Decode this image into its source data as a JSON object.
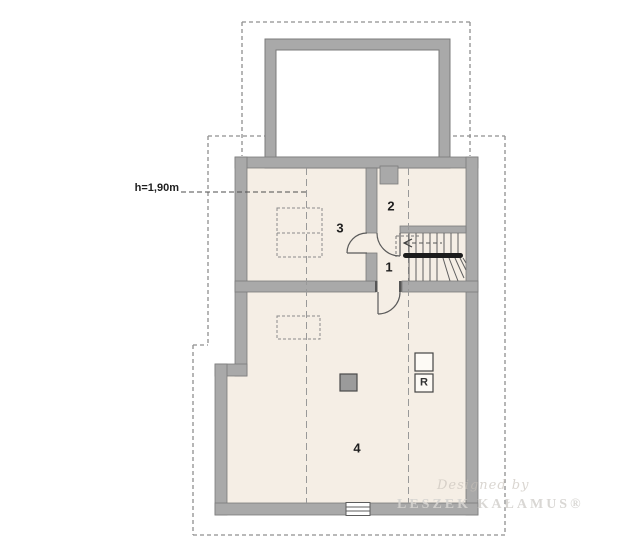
{
  "plan": {
    "annotations": {
      "height_line": "h=1,90m"
    },
    "rooms": {
      "r1": "1",
      "r2": "2",
      "r3": "3",
      "r4": "4"
    },
    "equipment": {
      "r_box": "R"
    },
    "watermark": {
      "designed_by": "Designed by",
      "author": "LESZEK KAŁAMUS®"
    },
    "colors": {
      "wall": "#a9a9a9",
      "floor": "#f5eee5",
      "outline": "#7b7b7b",
      "roof_dash": "#8f8f8f",
      "ink": "#222222"
    }
  }
}
